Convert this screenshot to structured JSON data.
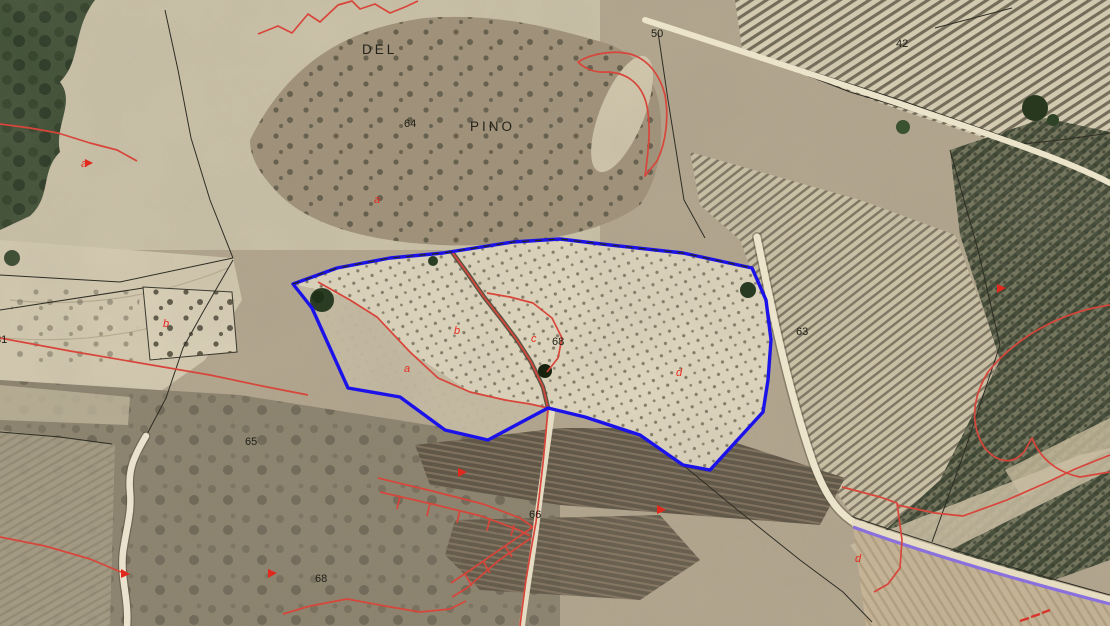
{
  "map": {
    "place_name_labels": [
      {
        "text": "DEL",
        "x": 362,
        "y": 54
      },
      {
        "text": "PINO",
        "x": 470,
        "y": 131
      }
    ],
    "parcel_number_labels": [
      {
        "text": "50",
        "x": 651,
        "y": 37
      },
      {
        "text": "42",
        "x": 896,
        "y": 47
      },
      {
        "text": "64",
        "x": 404,
        "y": 127
      },
      {
        "text": "63",
        "x": 796,
        "y": 335
      },
      {
        "text": "65",
        "x": 245,
        "y": 445
      },
      {
        "text": "66",
        "x": 529,
        "y": 518
      },
      {
        "text": "68",
        "x": 552,
        "y": 345
      },
      {
        "text": "68",
        "x": 315,
        "y": 582
      },
      {
        "text": "81",
        "x": -5,
        "y": 343
      }
    ],
    "subparcel_letter_labels": [
      {
        "text": "a",
        "x": 374,
        "y": 203
      },
      {
        "text": "a",
        "x": 404,
        "y": 372
      },
      {
        "text": "b",
        "x": 454,
        "y": 334
      },
      {
        "text": "c",
        "x": 531,
        "y": 342
      },
      {
        "text": "d",
        "x": 676,
        "y": 376
      },
      {
        "text": "b",
        "x": 163,
        "y": 327
      },
      {
        "text": "d",
        "x": 855,
        "y": 562
      },
      {
        "text": "a",
        "x": 81,
        "y": 167
      }
    ],
    "colors": {
      "selected_parcel_outline": "#1b12ea",
      "cadastral_boundary_red": "#d8453a",
      "subparcel_letter_red": "#e8281e",
      "road_overlay_purple": "#8a70dc",
      "label_text_black": "#1c1c15"
    }
  }
}
